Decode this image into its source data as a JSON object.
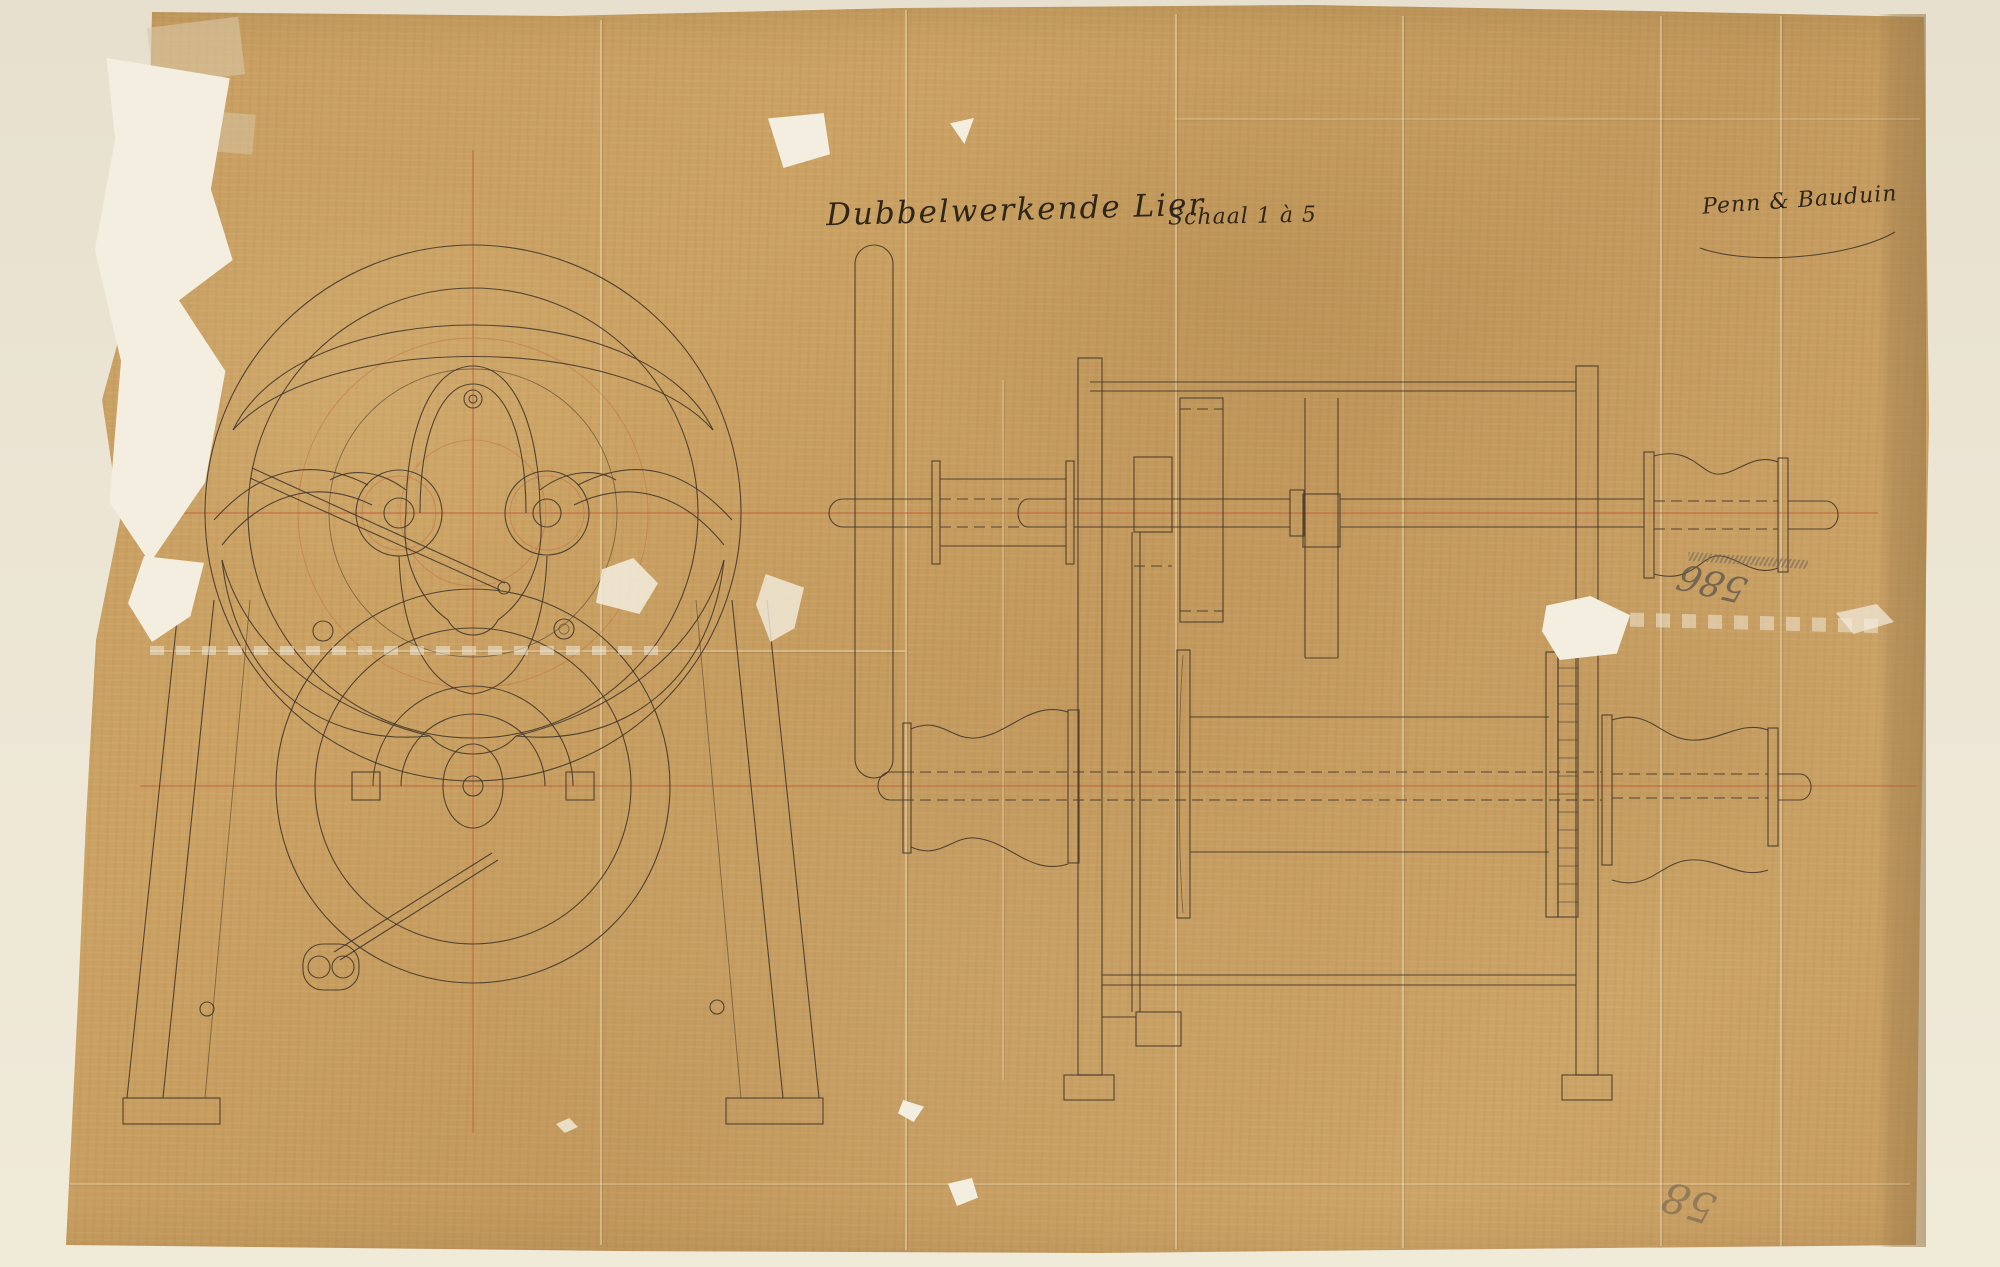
{
  "document": {
    "title_script": "Dubbelwerkende Lier",
    "scale_note": "Schaal 1 à 5",
    "signature": "Penn & Bauduin",
    "pencil_number_center_right": "586",
    "pencil_number_bottom_right": "58"
  },
  "drawing": {
    "left_view": "front view of winch with flywheel, curved spokes, two gear hubs and A-frame stand",
    "right_view": "side elevation of double-acting winch with crank bar, shafts, gears, rope drum and warping heads",
    "centerlines": "red horizontal and vertical construction centerlines"
  },
  "colors": {
    "paper": "#c89e62",
    "mat": "#ece5d4",
    "tear_white": "#f3eedf",
    "ink": "#41362a",
    "centerline_red": "#c2603c",
    "pencil": "#6f665a",
    "edge_strip": "#a0794c"
  }
}
